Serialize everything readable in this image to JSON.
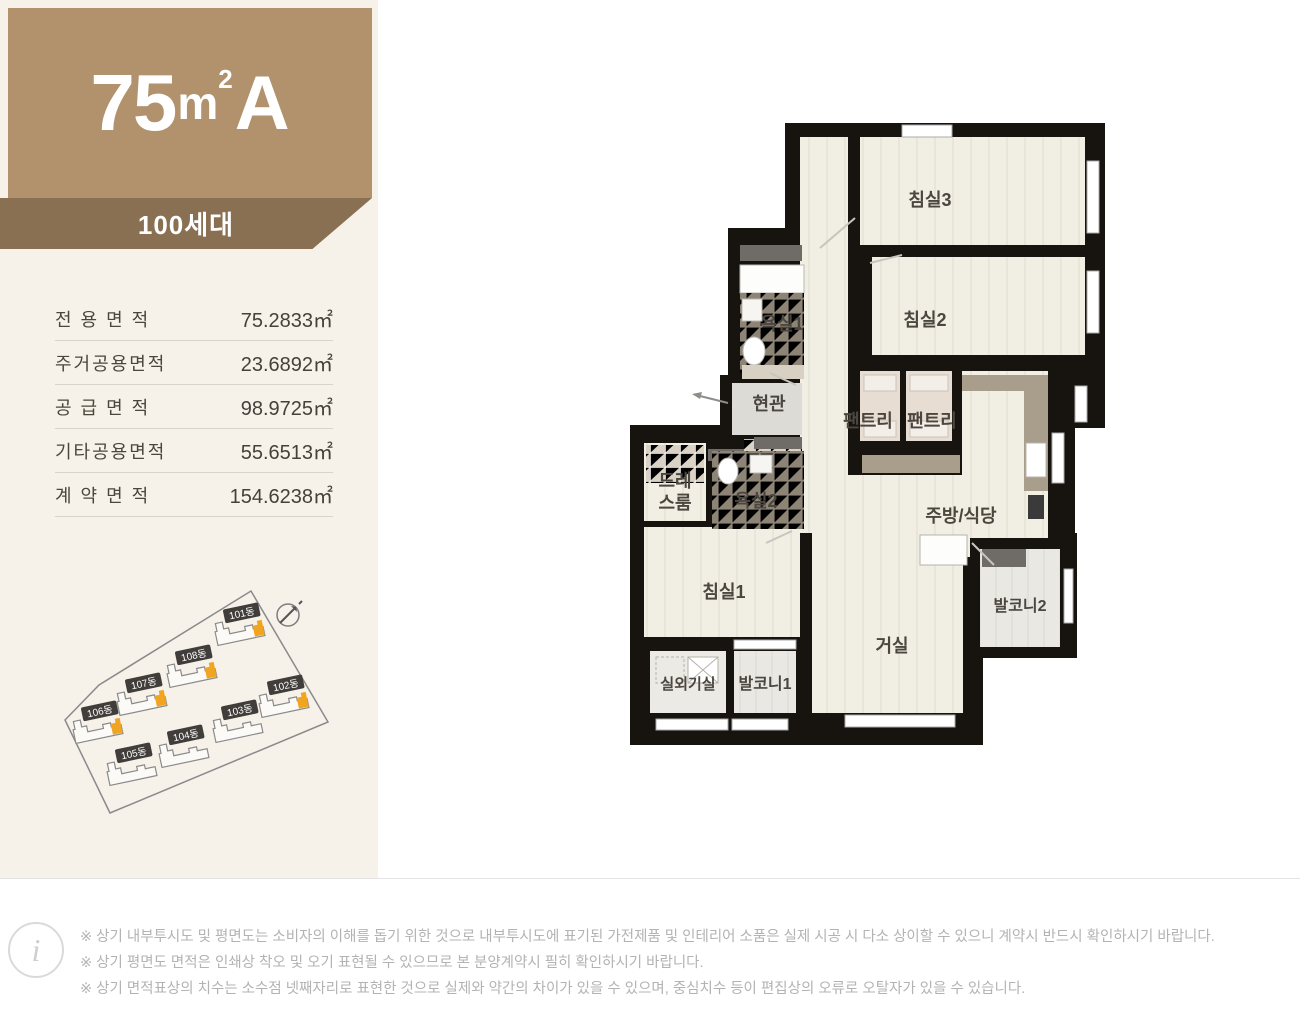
{
  "header": {
    "area_number": "75",
    "area_unit": "m",
    "area_sup": "2",
    "type_letter": "A",
    "households_badge": "100세대"
  },
  "area_table": {
    "rows": [
      {
        "label": "전 용 면 적",
        "value": "75.2833㎡"
      },
      {
        "label": "주거공용면적",
        "value": "23.6892㎡"
      },
      {
        "label": "공 급 면 적",
        "value": "98.9725㎡"
      },
      {
        "label": "기타공용면적",
        "value": "55.6513㎡"
      },
      {
        "label": "계 약 면 적",
        "value": "154.6238㎡"
      }
    ]
  },
  "sitemap": {
    "boundary_color": "#8a8a8a",
    "highlight_color": "#f0a41f",
    "buildings": [
      {
        "label": "101동",
        "x": 168,
        "y": 44,
        "highlight": true
      },
      {
        "label": "108동",
        "x": 120,
        "y": 86,
        "highlight": true
      },
      {
        "label": "107동",
        "x": 70,
        "y": 114,
        "highlight": true
      },
      {
        "label": "106동",
        "x": 26,
        "y": 142,
        "highlight": true
      },
      {
        "label": "102동",
        "x": 212,
        "y": 116,
        "highlight": true
      },
      {
        "label": "103동",
        "x": 166,
        "y": 141,
        "highlight": false
      },
      {
        "label": "104동",
        "x": 112,
        "y": 166,
        "highlight": false
      },
      {
        "label": "105동",
        "x": 60,
        "y": 184,
        "highlight": false
      }
    ]
  },
  "floorplan": {
    "wall_color": "#17130f",
    "floor_color": "#f1efe4",
    "labels": {
      "bedroom3": "침실3",
      "bedroom2": "침실2",
      "bath1": "욕실1",
      "entrance": "현관",
      "pantry1": "팬트리",
      "pantry2": "팬트리",
      "kitchen": "주방/식당",
      "dress_line1": "드레",
      "dress_line2": "스룸",
      "bath2": "욕실2",
      "bedroom1": "침실1",
      "living": "거실",
      "balcony2": "발코니2",
      "ac_room": "실외기실",
      "balcony1": "발코니1"
    }
  },
  "footer": {
    "notes": [
      "※ 상기 내부투시도 및 평면도는 소비자의 이해를 돕기 위한 것으로 내부투시도에 표기된 가전제품 및 인테리어 소품은 실제 시공 시 다소 상이할 수 있으니 계약시 반드시 확인하시기 바랍니다.",
      "※ 상기 평면도 면적은 인쇄상 착오 및 오기 표현될 수 있으므로 본 분양계약시 필히 확인하시기 바랍니다.",
      "※ 상기 면적표상의 치수는 소수점 넷째자리로 표현한 것으로 실제와 약간의 차이가 있을 수 있으며, 중심치수 등이 편집상의 오류로 오탈자가 있을 수 있습니다."
    ]
  }
}
